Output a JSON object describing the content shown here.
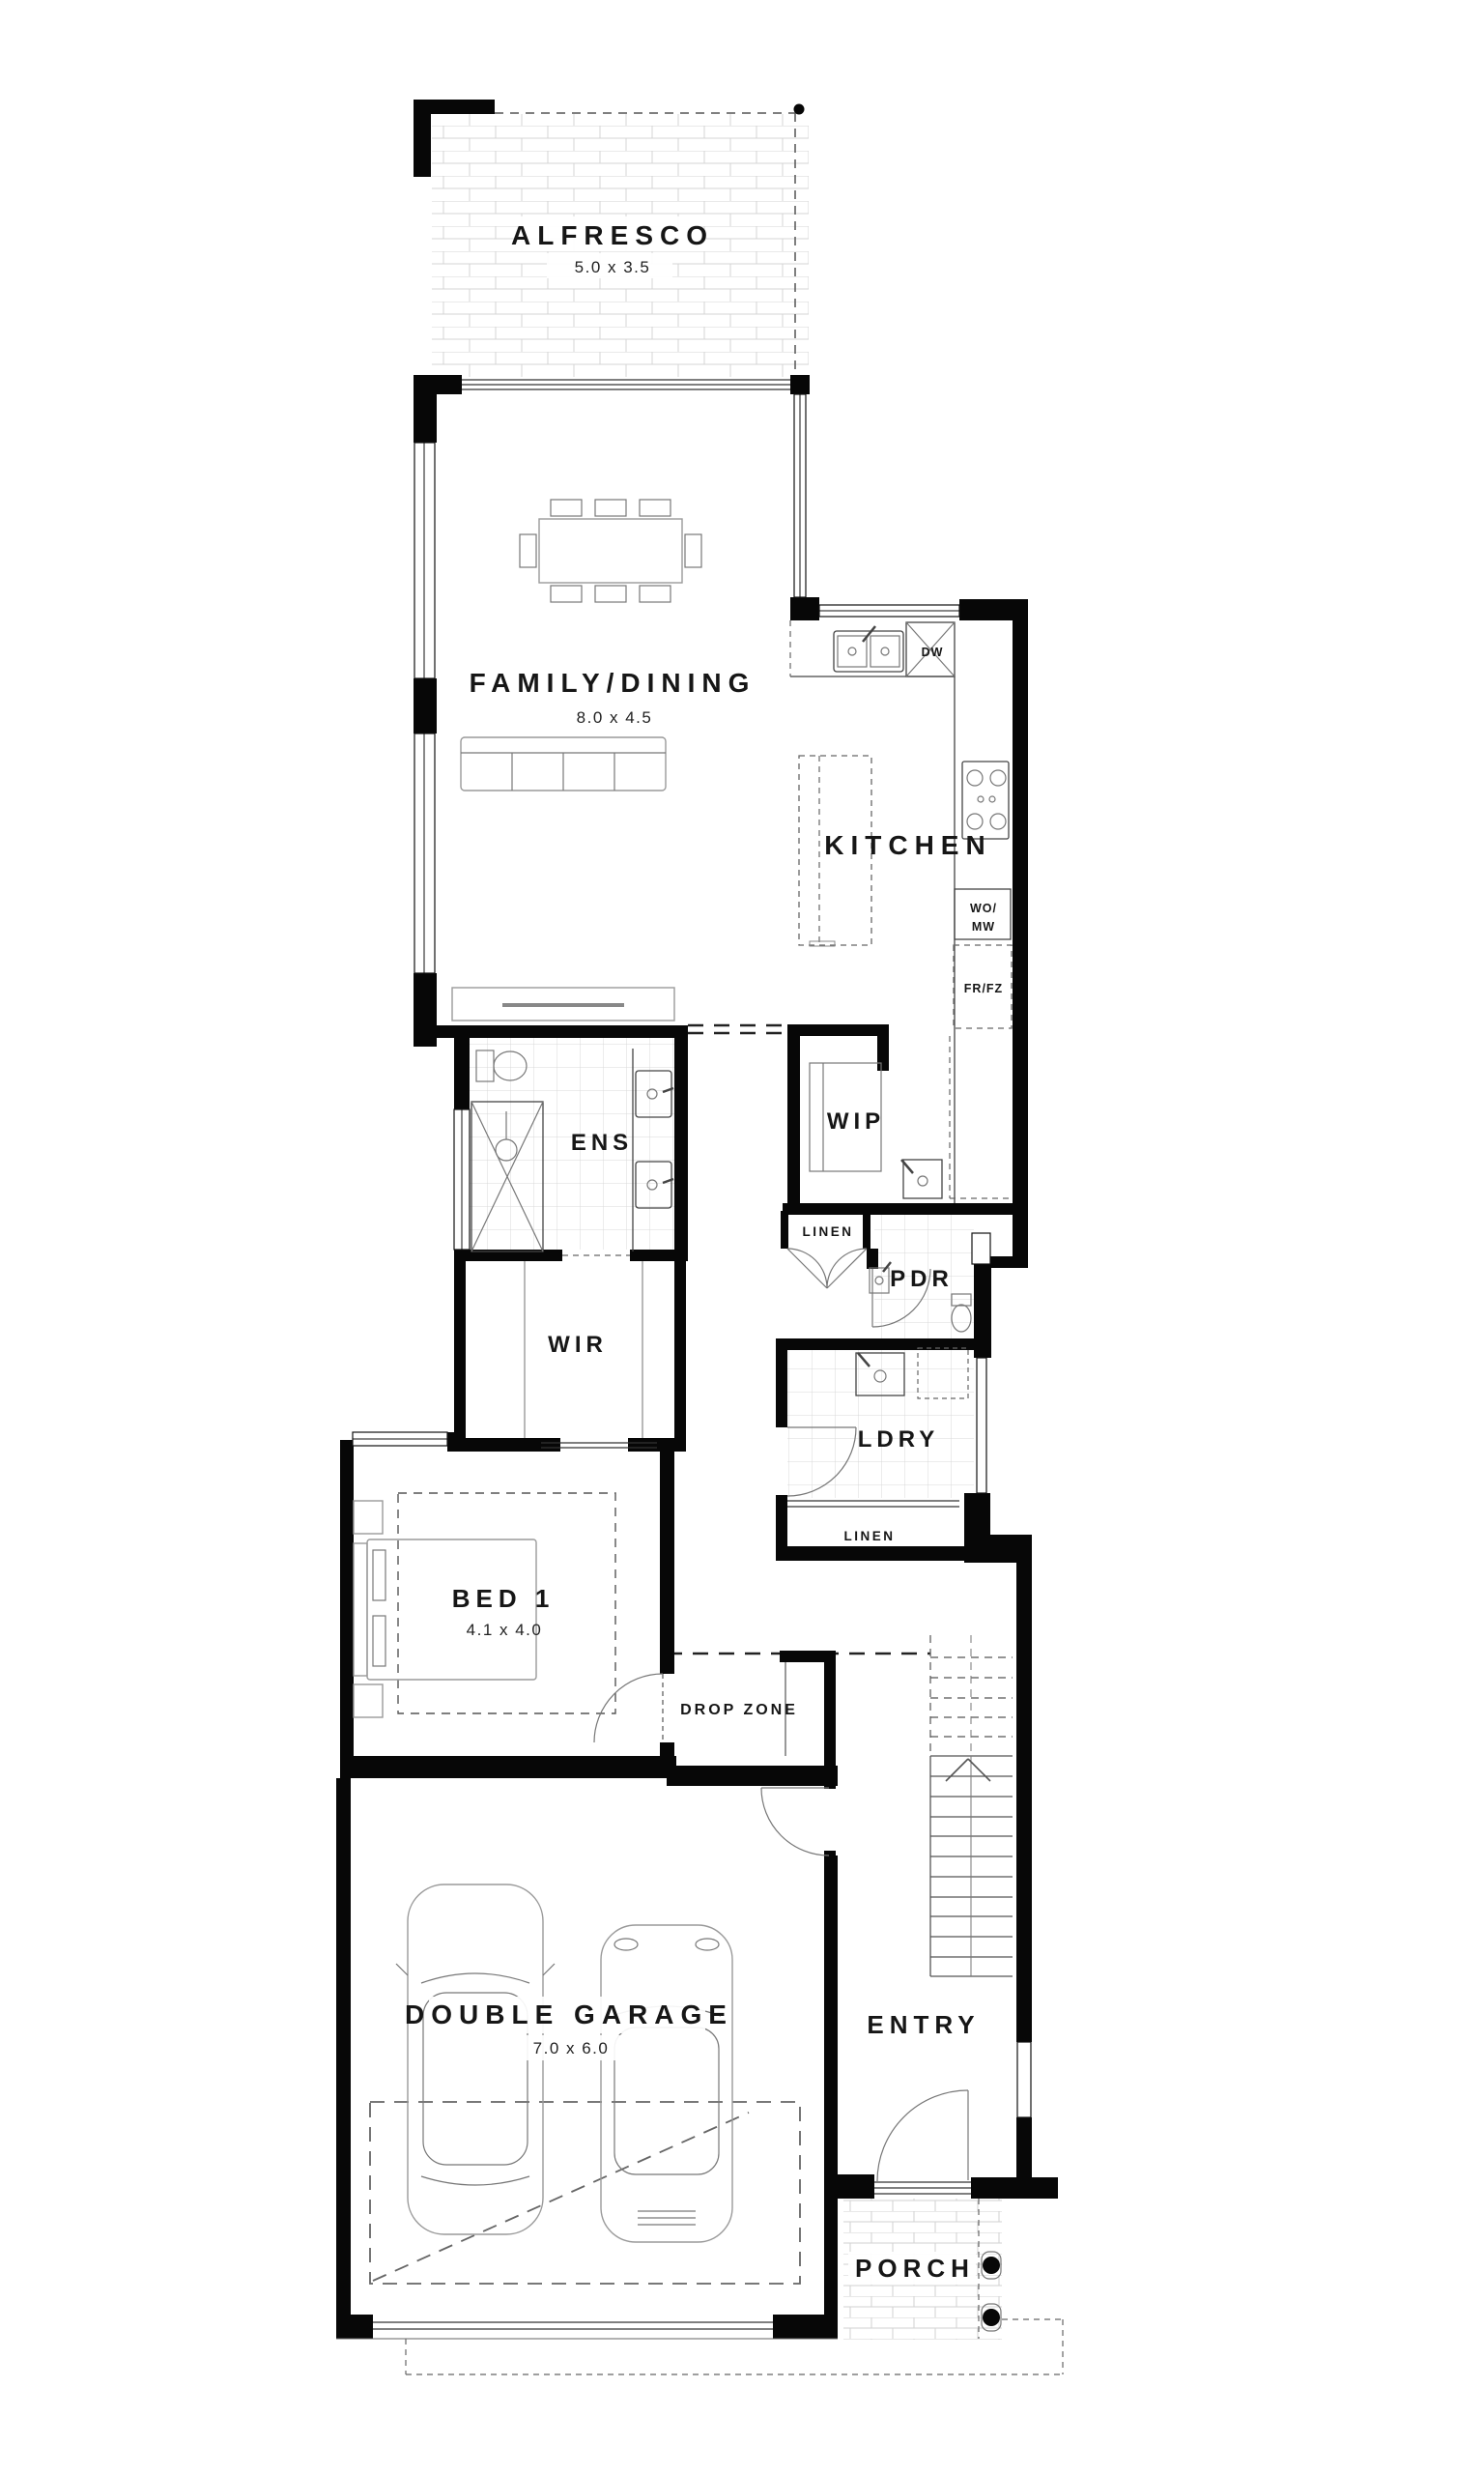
{
  "plan": {
    "rooms": {
      "alfresco": {
        "name": "ALFRESCO",
        "size": "5.0 x 3.5"
      },
      "family_dining": {
        "name": "FAMILY/DINING",
        "size": "8.0 x 4.5"
      },
      "kitchen": {
        "name": "KITCHEN"
      },
      "wip": {
        "name": "WIP"
      },
      "ens": {
        "name": "ENS"
      },
      "wir": {
        "name": "WIR"
      },
      "pdr": {
        "name": "PDR"
      },
      "ldry": {
        "name": "LDRY"
      },
      "linen_hall": {
        "name": "LINEN"
      },
      "linen_ldry": {
        "name": "LINEN"
      },
      "bed1": {
        "name": "BED 1",
        "size": "4.1 x 4.0"
      },
      "drop_zone": {
        "name": "DROP ZONE"
      },
      "garage": {
        "name": "DOUBLE GARAGE",
        "size": "7.0 x 6.0"
      },
      "entry": {
        "name": "ENTRY"
      },
      "porch": {
        "name": "PORCH"
      }
    },
    "appliances": {
      "dishwasher": "DW",
      "wall_oven_microwave_line1": "WO/",
      "wall_oven_microwave_line2": "MW",
      "fridge_freezer": "FR/FZ"
    },
    "colors": {
      "wall": "#070707",
      "floor": "#ffffff",
      "tile_line": "#d6d6d6",
      "text": "#161616"
    }
  }
}
